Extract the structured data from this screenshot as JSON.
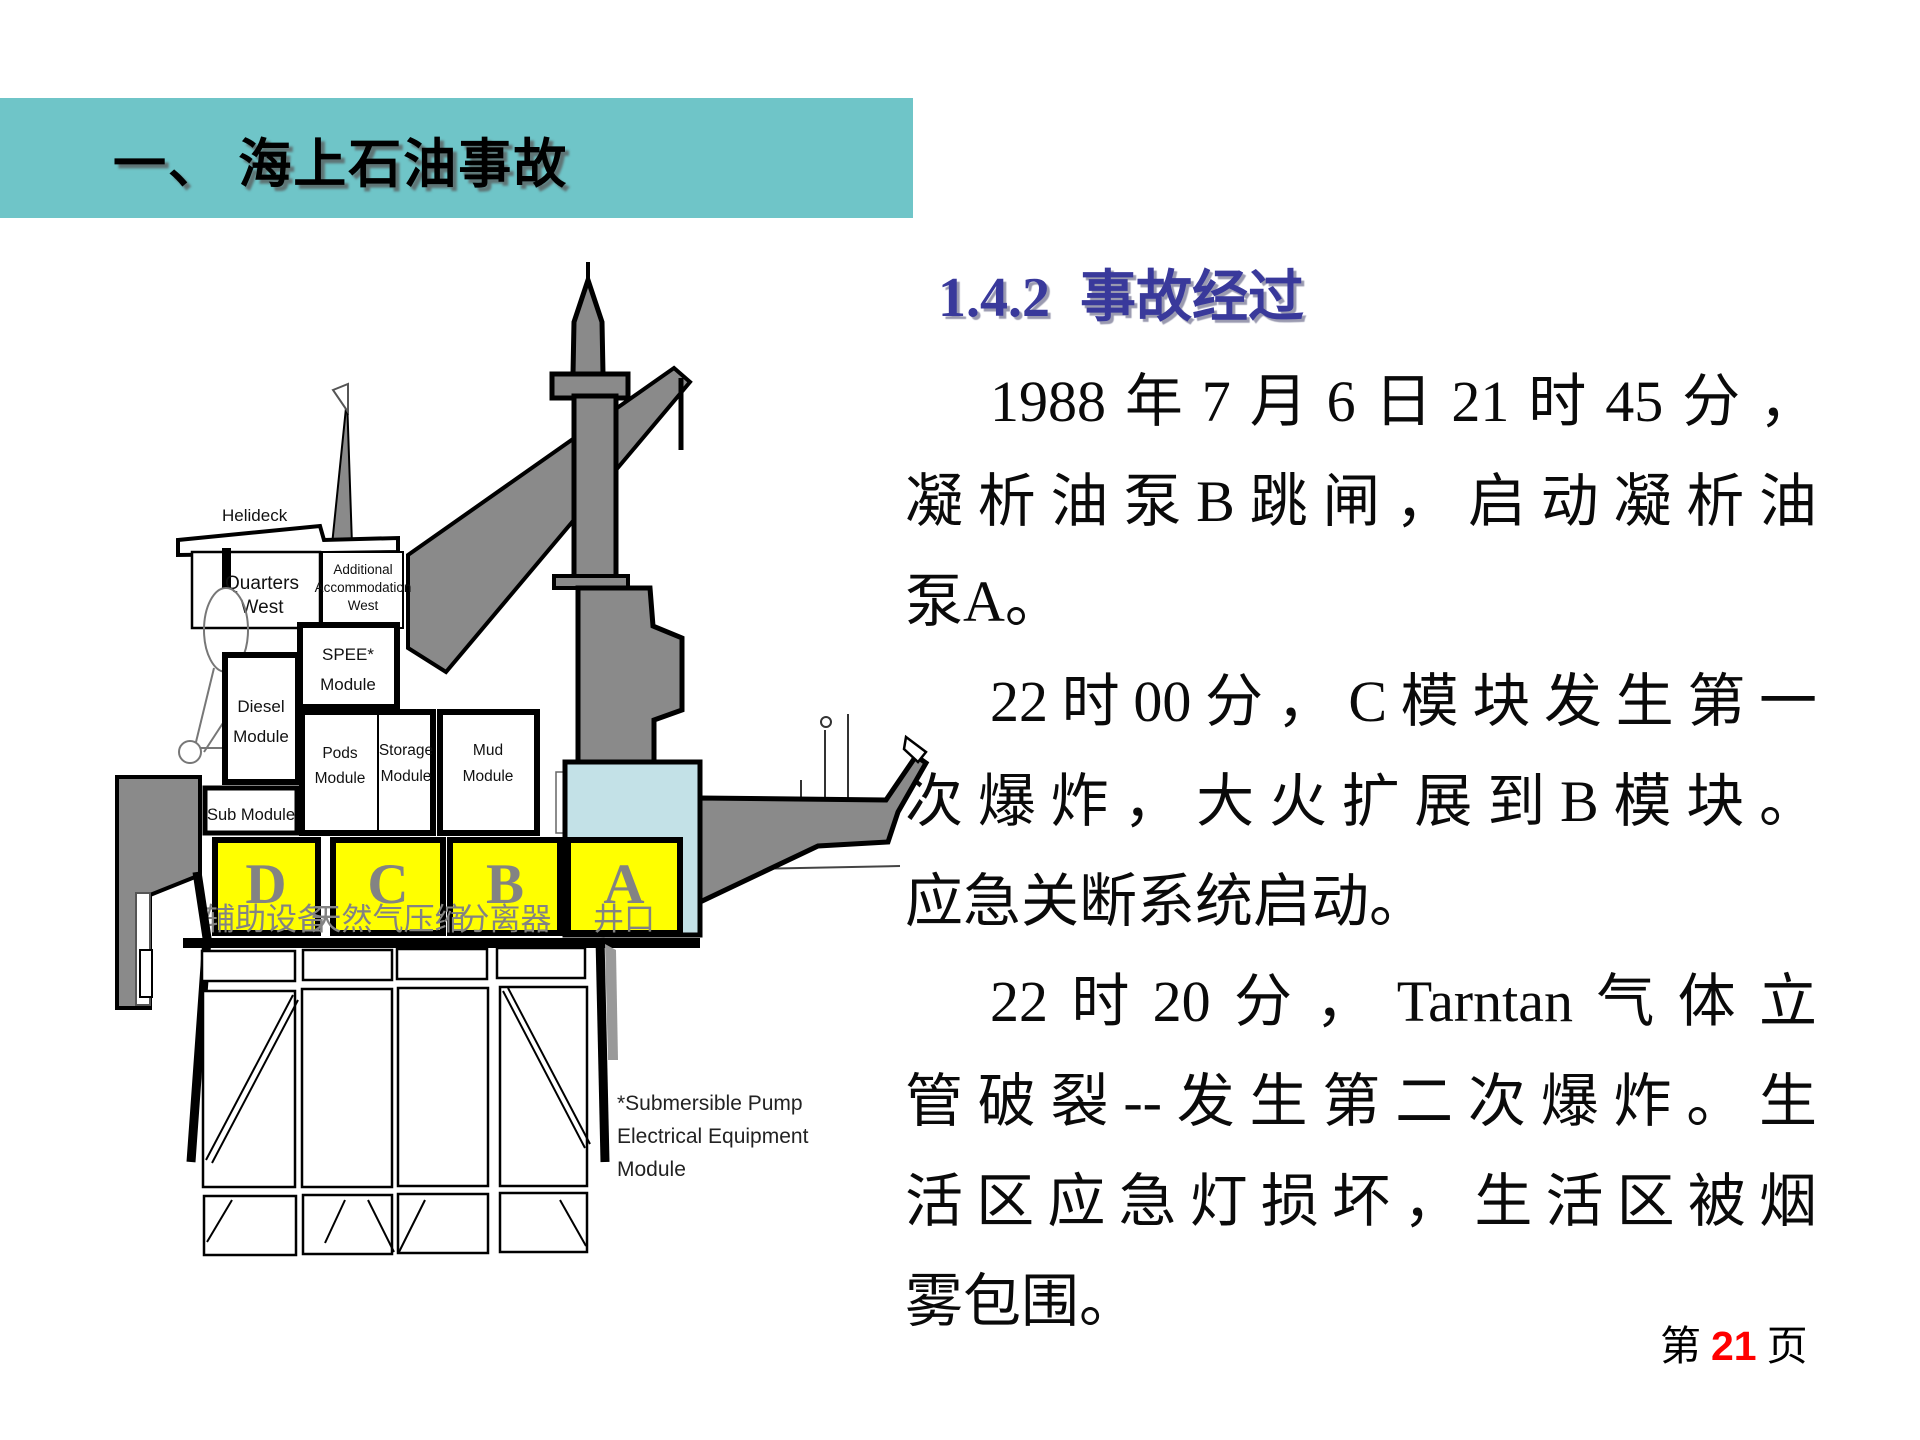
{
  "banner": {
    "title": "一、 海上石油事故",
    "bg_color": "#6FC5C8"
  },
  "section": {
    "heading_number": "1.4.2",
    "heading_title": "事故经过",
    "heading_color": "#39399B"
  },
  "body": {
    "lines": [
      {
        "text": "1988年7月6日21时45分，"
      },
      {
        "text": "凝析油泵B跳闸，启动凝析油"
      },
      {
        "text": "泵A。"
      },
      {
        "text": "22时00分，C模块发生第一"
      },
      {
        "text": "次爆炸，大火扩展到B模块。"
      },
      {
        "text": "应急关断系统启动。"
      },
      {
        "text": "22时20分，Tarntan气体立"
      },
      {
        "text": "管破裂--发生第二次爆炸。生"
      },
      {
        "text": "活区应急灯损坏，生活区被烟"
      },
      {
        "text": "雾包围。"
      }
    ]
  },
  "footer": {
    "prefix": "第",
    "page_number": "21",
    "suffix": "页",
    "number_color": "#FF0000"
  },
  "diagram": {
    "labels": {
      "helideck": "Helideck",
      "quarters_west": [
        "Quarters",
        "West"
      ],
      "additional_accommodation": [
        "Additional",
        "Accommodation",
        "West"
      ],
      "spee": [
        "SPEE*",
        "Module"
      ],
      "diesel": [
        "Diesel",
        "Module"
      ],
      "pods": [
        "Pods",
        "Module"
      ],
      "storage": [
        "Storage",
        "Module"
      ],
      "mud": [
        "Mud",
        "Module"
      ],
      "sub": "Sub Module",
      "submersible_note": [
        "*Submersible Pump",
        "Electrical Equipment",
        "Module"
      ]
    },
    "modules": [
      {
        "letter": "D",
        "label": "辅助设备"
      },
      {
        "letter": "C",
        "label": "天然气压缩"
      },
      {
        "letter": "B",
        "label": "分离器"
      },
      {
        "letter": "A",
        "label": "井口"
      }
    ],
    "colors": {
      "module_fill": "#FFFF00",
      "structure_gray": "#8A8A8A",
      "wellbay_blue": "#C3E1E7",
      "letter_gray": "#838383"
    }
  }
}
